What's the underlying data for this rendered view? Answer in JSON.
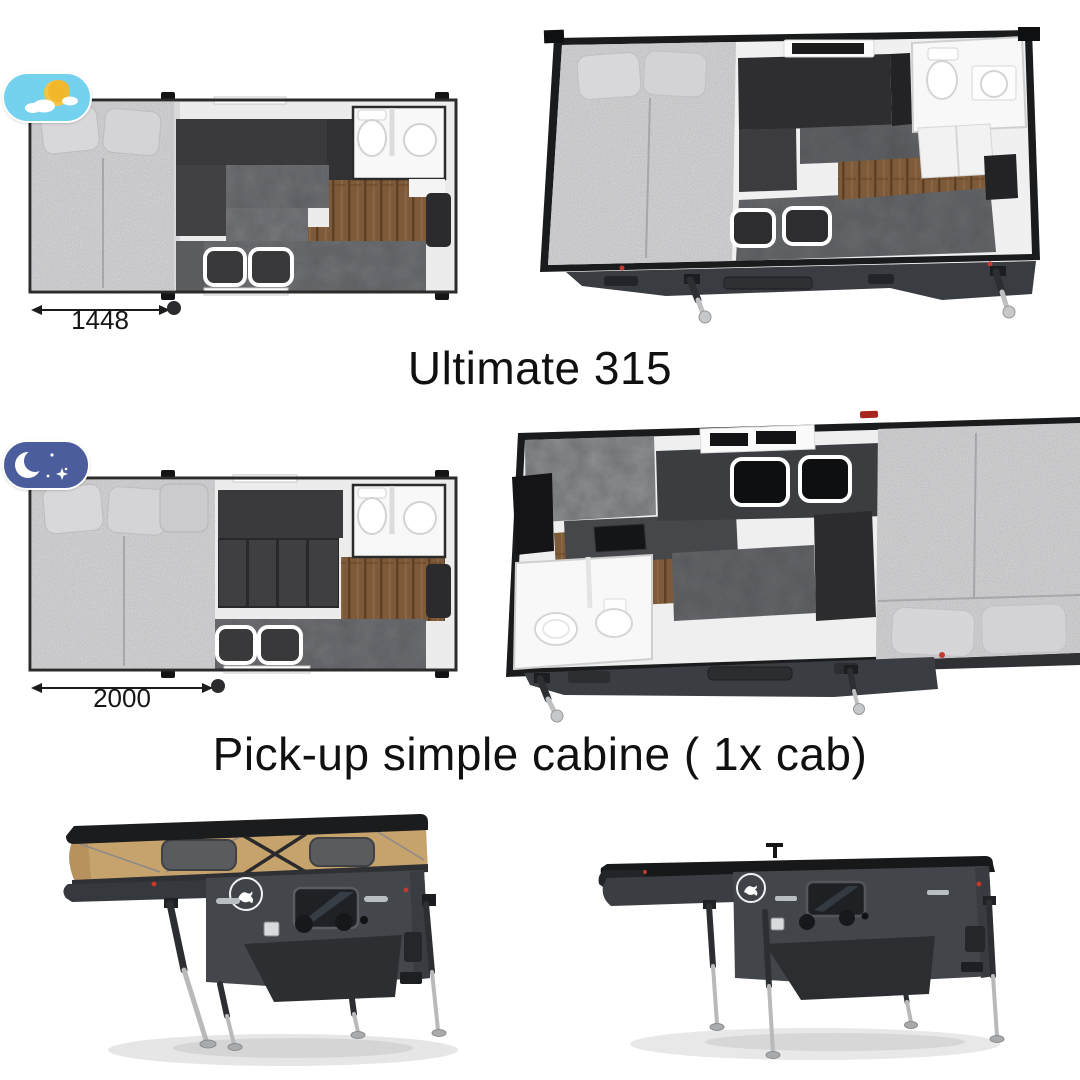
{
  "sections": {
    "model_1": {
      "title": "Ultimate 315",
      "day_plan": {
        "dimension_mm": "1448",
        "mode_icon": "day-sun-cloud-toggle"
      },
      "views": [
        "floorplan-day-top",
        "render-3d-top-open"
      ]
    },
    "model_2": {
      "title": "Pick-up simple cabine ( 1x cab)",
      "night_plan": {
        "dimension_mm": "2000",
        "mode_icon": "night-moon-stars-toggle"
      },
      "views": [
        "floorplan-night-top",
        "render-3d-top-open-reversed"
      ]
    },
    "exterior": {
      "left_view": "popup-roof-raised-camper",
      "right_view": "popup-roof-closed-camper",
      "badge": "kangaroo-logo"
    }
  },
  "colors": {
    "background": "#ffffff",
    "day_toggle": "#74d2ef",
    "night_toggle": "#4c5d9d",
    "sun": "#f3b72c",
    "canvas_tan": "#c6a26c",
    "body_gray": "#43464b",
    "dark_charcoal": "#3a3a3d",
    "mattress_gray": "#b6b6b8",
    "wood_floor": "#7d5a39",
    "bathroom_white": "#f8f8f8",
    "text": "#101010"
  }
}
